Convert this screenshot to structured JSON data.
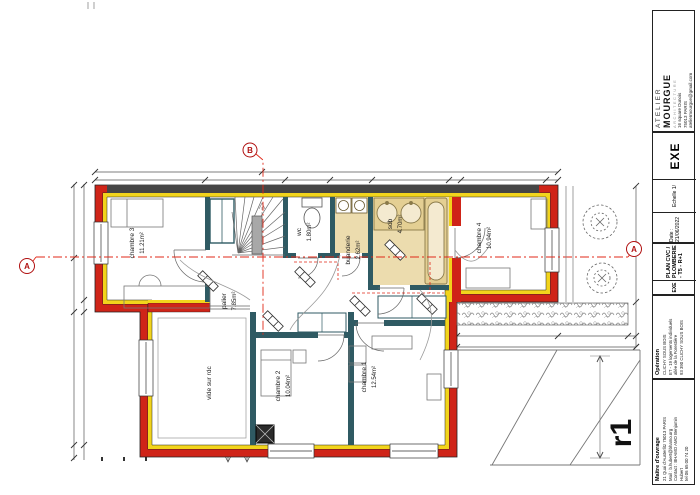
{
  "title_block": {
    "studio": {
      "name_line1": "ATELIER",
      "name_line2": "MOURGUE",
      "name_line3": "ARCHITECTURE",
      "address_line1": "16 square Dunois",
      "address_line2": "75013 PARIS",
      "email": "ateliermourgue@gmail.com"
    },
    "phase_cell": {
      "phase": "EXE",
      "scale": "Echelle 1/",
      "date": "Date : 21/06/2022"
    },
    "drawing_cell": {
      "phase": "EXE",
      "title": "PLAN CVC / PLOMBERIE - T5 - R+1"
    },
    "operation_cell": {
      "header": "Opération",
      "line1": "CLICHY SOUS BOIS",
      "line2": "ET - 19 logements individuels",
      "line3": "allée de la Forestière",
      "line4": "93 390 CLICHY SOUS BOIS"
    },
    "owner_cell": {
      "header": "Maître d'ouvrage",
      "line1": "21 Quai d'Austerlitz 75013 PARIS",
      "line2": "Mail : b.hubert@bhamo.org",
      "line3": "Contact : BHAMO AMO Benjamin",
      "line4": "Hubert",
      "line5": "tel 06 65 00 74 20"
    },
    "revision": "r1"
  },
  "plan": {
    "rooms": [
      {
        "id": "chambre3",
        "label": "chambre 3",
        "area": "11.21m²"
      },
      {
        "id": "wc",
        "label": "wc",
        "area": "1.80m²"
      },
      {
        "id": "buanderie",
        "label": "buanderie",
        "area": "2.62m²"
      },
      {
        "id": "sdb",
        "label": "sdb",
        "area": "4.70m²"
      },
      {
        "id": "chambre4",
        "label": "chambre 4",
        "area": "10.94m²"
      },
      {
        "id": "palier",
        "label": "palier",
        "area": "7.85m²"
      },
      {
        "id": "vide",
        "label": "vide sur rdc",
        "area": ""
      },
      {
        "id": "chambre2",
        "label": "chambre 2",
        "area": "10.04m²"
      },
      {
        "id": "chambre1",
        "label": "chambre 1",
        "area": "12.54m²"
      }
    ],
    "markers": {
      "section_a": "A",
      "section_b": "B"
    },
    "colors": {
      "wall_red": "#cf2418",
      "wall_yellow": "#f2d41c",
      "wall_dark": "#454545",
      "partition_teal": "#2f5a63",
      "floor_beige": "#ecdcae",
      "pipe_red": "#e02818"
    }
  }
}
